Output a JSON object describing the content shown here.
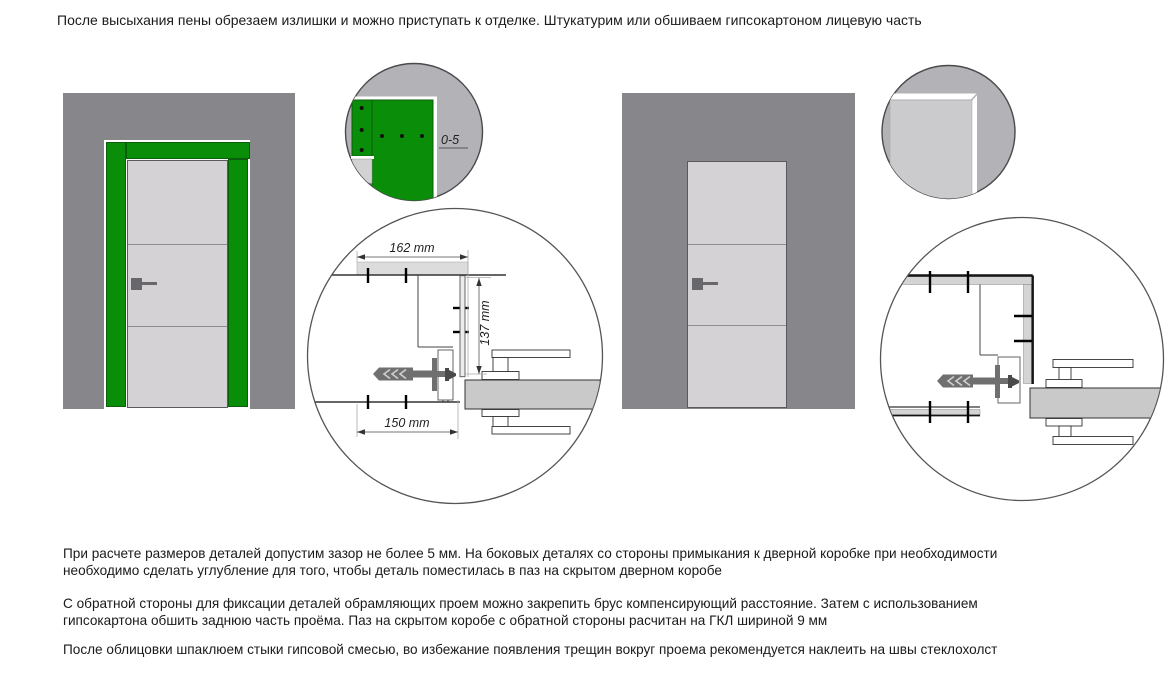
{
  "header": {
    "text": "После высыхания пены обрезаем излишки и можно приступать к отделке. Штукатурим или обшиваем гипсокартоном лицевую часть"
  },
  "scene_left": {
    "description": "door-opening-framed-with-green-boards",
    "detail_circle": {
      "gap_label": "0-5"
    },
    "section_circle": {
      "dim_width_top": "162 mm",
      "dim_height": "137 mm",
      "dim_width_bottom": "150 mm"
    }
  },
  "scene_right": {
    "description": "door-opening-after-plaster-finish"
  },
  "footer": {
    "paragraphs": [
      {
        "lines": [
          "При расчете размеров деталей допустим зазор не более 5 мм. На боковых деталях со стороны примыкания к дверной коробке при необходимости",
          "необходимо сделать углубление для того, чтобы деталь поместилась в паз на скрытом дверном коробе"
        ]
      },
      {
        "lines": [
          "С обратной стороны для фиксации деталей обрамляющих проем можно закрепить брус компенсирующий расстояние. Затем с использованием",
          "гипсокартона обшить заднюю часть проёма. Паз на скрытом коробе с обратной стороны расчитан на ГКЛ шириной 9 мм"
        ]
      },
      {
        "lines": [
          "После облицовки шпаклюем стыки гипсовой смесью, во избежание появления трещин вокруг проема рекомендуется наклеить на швы стеклохолст"
        ]
      }
    ]
  },
  "colors": {
    "wall_gray": "#87878b",
    "door_gray": "#d4d2d4",
    "frame_green": "#0a8e0a",
    "frame_green_edge": "#0b5e0b",
    "detail_circle_bg": "#b3b2b6",
    "panel_light_gray": "#cbcacd",
    "section_door_leaf": "#c9c9c9",
    "anchor_gray": "#6f6f6f",
    "cladding_gray": "#d4d4d4"
  }
}
